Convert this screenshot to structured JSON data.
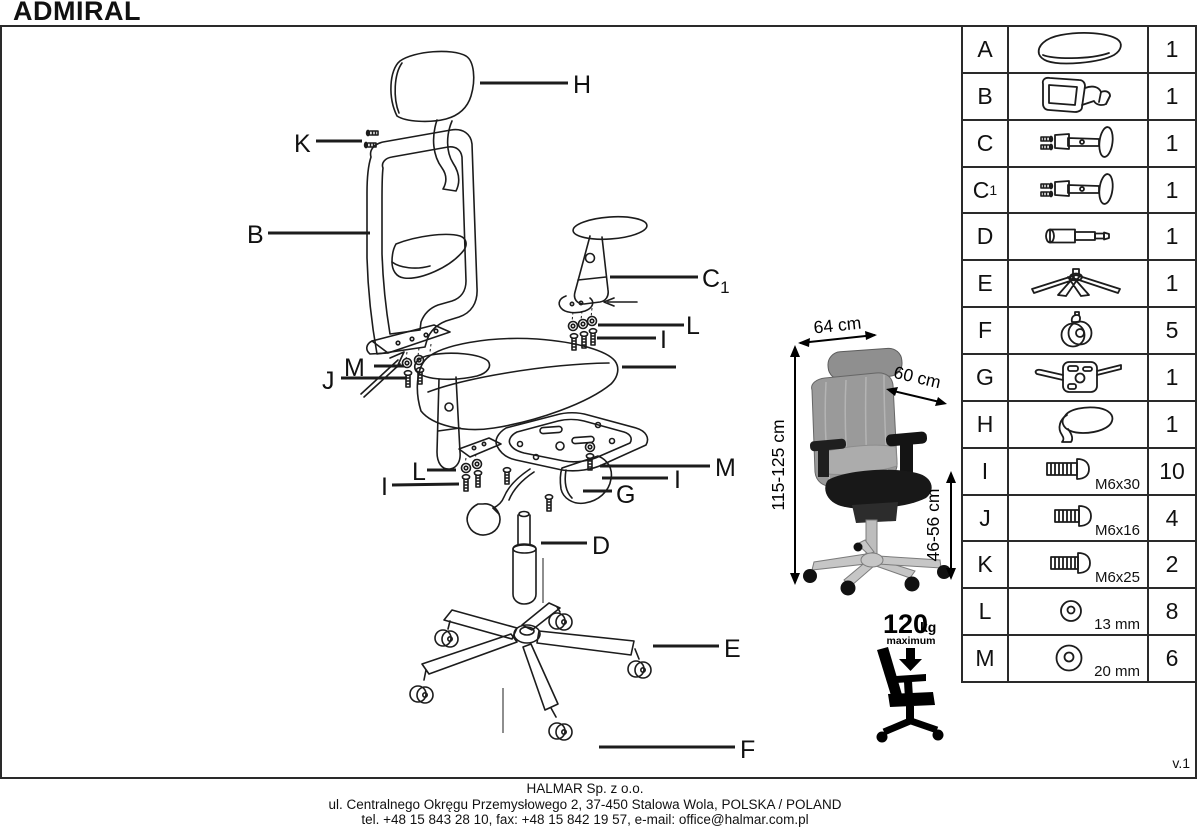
{
  "title": "ADMIRAL",
  "version": "v.1",
  "footer": {
    "company": "HALMAR Sp. z o.o.",
    "address": "ul. Centralnego Okręgu Przemysłowego 2, 37-450 Stalowa Wola, POLSKA / POLAND",
    "contact": "tel. +48 15 843 28 10, fax: +48 15 842 19 57, e-mail: office@halmar.com.pl"
  },
  "dimensions": {
    "width": "64 cm",
    "depth": "60 cm",
    "height": "115-125 cm",
    "seat_height": "46-56 cm"
  },
  "weight_limit": {
    "value": "120",
    "unit": "kg",
    "label": "maximum"
  },
  "diagram_labels": {
    "h": "H",
    "k": "K",
    "b": "B",
    "c1": "C",
    "c1_sub": "1",
    "l_right": "L",
    "i_right": "I",
    "m_left": "M",
    "j": "J",
    "c": "C",
    "l_left": "L",
    "i_left": "I",
    "m_right": "M",
    "i_mid": "I",
    "g": "G",
    "d": "D",
    "e": "E",
    "f": "F"
  },
  "parts_table": {
    "rows": [
      {
        "letter": "A",
        "sub": "",
        "icon": "seat-icon",
        "qty": "1",
        "spec": ""
      },
      {
        "letter": "B",
        "sub": "",
        "icon": "backrest-icon",
        "qty": "1",
        "spec": ""
      },
      {
        "letter": "C",
        "sub": "",
        "icon": "armrest-icon",
        "qty": "1",
        "spec": ""
      },
      {
        "letter": "C",
        "sub": "1",
        "icon": "armrest-icon",
        "qty": "1",
        "spec": ""
      },
      {
        "letter": "D",
        "sub": "",
        "icon": "gas-lift-icon",
        "qty": "1",
        "spec": ""
      },
      {
        "letter": "E",
        "sub": "",
        "icon": "base-icon",
        "qty": "1",
        "spec": ""
      },
      {
        "letter": "F",
        "sub": "",
        "icon": "caster-icon",
        "qty": "5",
        "spec": ""
      },
      {
        "letter": "G",
        "sub": "",
        "icon": "mechanism-icon",
        "qty": "1",
        "spec": ""
      },
      {
        "letter": "H",
        "sub": "",
        "icon": "headrest-icon",
        "qty": "1",
        "spec": ""
      },
      {
        "letter": "I",
        "sub": "",
        "icon": "screw-icon",
        "qty": "10",
        "spec": "M6x30"
      },
      {
        "letter": "J",
        "sub": "",
        "icon": "screw-icon",
        "qty": "4",
        "spec": "M6x16"
      },
      {
        "letter": "K",
        "sub": "",
        "icon": "screw-icon",
        "qty": "2",
        "spec": "M6x25"
      },
      {
        "letter": "L",
        "sub": "",
        "icon": "washer-icon",
        "qty": "8",
        "spec": "13 mm"
      },
      {
        "letter": "M",
        "sub": "",
        "icon": "washer-icon",
        "qty": "6",
        "spec": "20 mm"
      }
    ]
  }
}
